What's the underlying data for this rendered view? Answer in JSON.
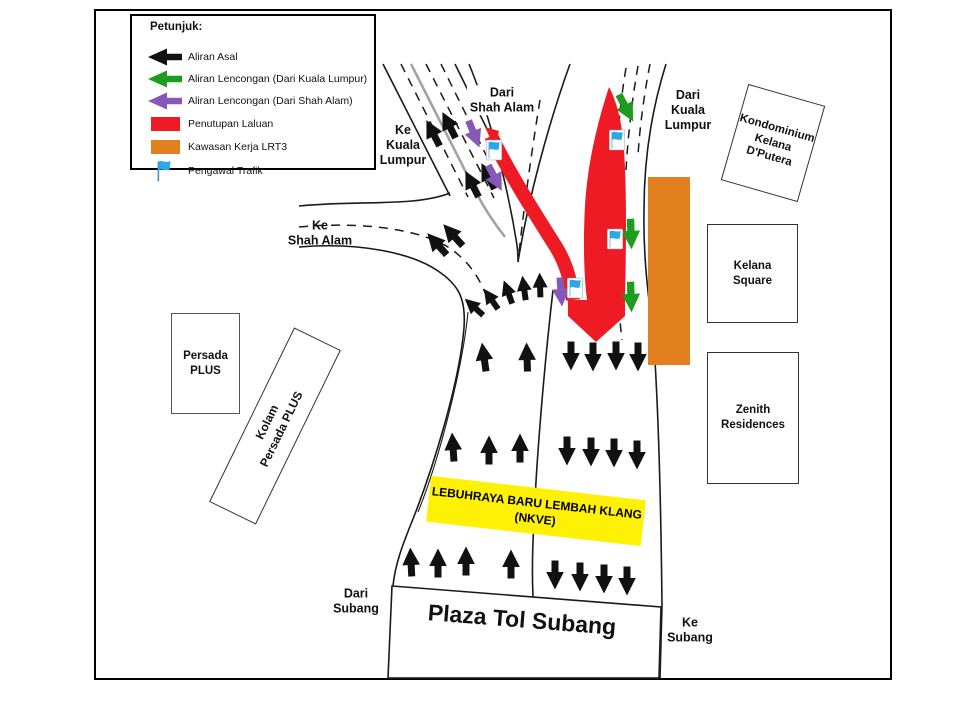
{
  "legend": {
    "title": "Petunjuk:",
    "items": [
      {
        "icon": "black-arrow",
        "label": "Aliran Asal"
      },
      {
        "icon": "green-arrow",
        "label": "Aliran Lencongan (Dari Kuala Lumpur)"
      },
      {
        "icon": "purple-arrow",
        "label": "Aliran Lencongan (Dari Shah Alam)"
      },
      {
        "icon": "red-swatch",
        "label": "Penutupan Laluan"
      },
      {
        "icon": "orange-swatch",
        "label": "Kawasan Kerja LRT3"
      },
      {
        "icon": "blue-flag",
        "label": "Pengawal Trafik"
      }
    ]
  },
  "colors": {
    "closure_red": "#EE1B24",
    "work_orange": "#E2801F",
    "diversion_kl_green": "#1E9C1E",
    "diversion_sa_purple": "#8659B8",
    "flag_blue": "#29A9E8",
    "nkve_yellow": "#FFF104",
    "original_black": "#111111"
  },
  "map": {
    "labels": {
      "dari_shah_alam": [
        "Dari",
        "Shah Alam"
      ],
      "ke_kuala_lumpur": [
        "Ke",
        "Kuala",
        "Lumpur"
      ],
      "ke_shah_alam": [
        "Ke",
        "Shah Alam"
      ],
      "dari_kuala_lumpur": [
        "Dari",
        "Kuala",
        "Lumpur"
      ],
      "dari_subang": [
        "Dari",
        "Subang"
      ],
      "ke_subang": [
        "Ke",
        "Subang"
      ],
      "plaza_tol": "Plaza Tol Subang",
      "nkve": [
        "LEBUHRAYA BARU LEMBAH KLANG",
        "(NKVE)"
      ]
    },
    "buildings": {
      "kondominium": [
        "Kondominium",
        "Kelana",
        "D'Putera"
      ],
      "kelana_square": [
        "Kelana",
        "Square"
      ],
      "zenith": [
        "Zenith",
        "Residences"
      ],
      "persada_plus": [
        "Persada",
        "PLUS"
      ],
      "kolam": [
        "Kolam",
        "Persada PLUS"
      ]
    }
  }
}
